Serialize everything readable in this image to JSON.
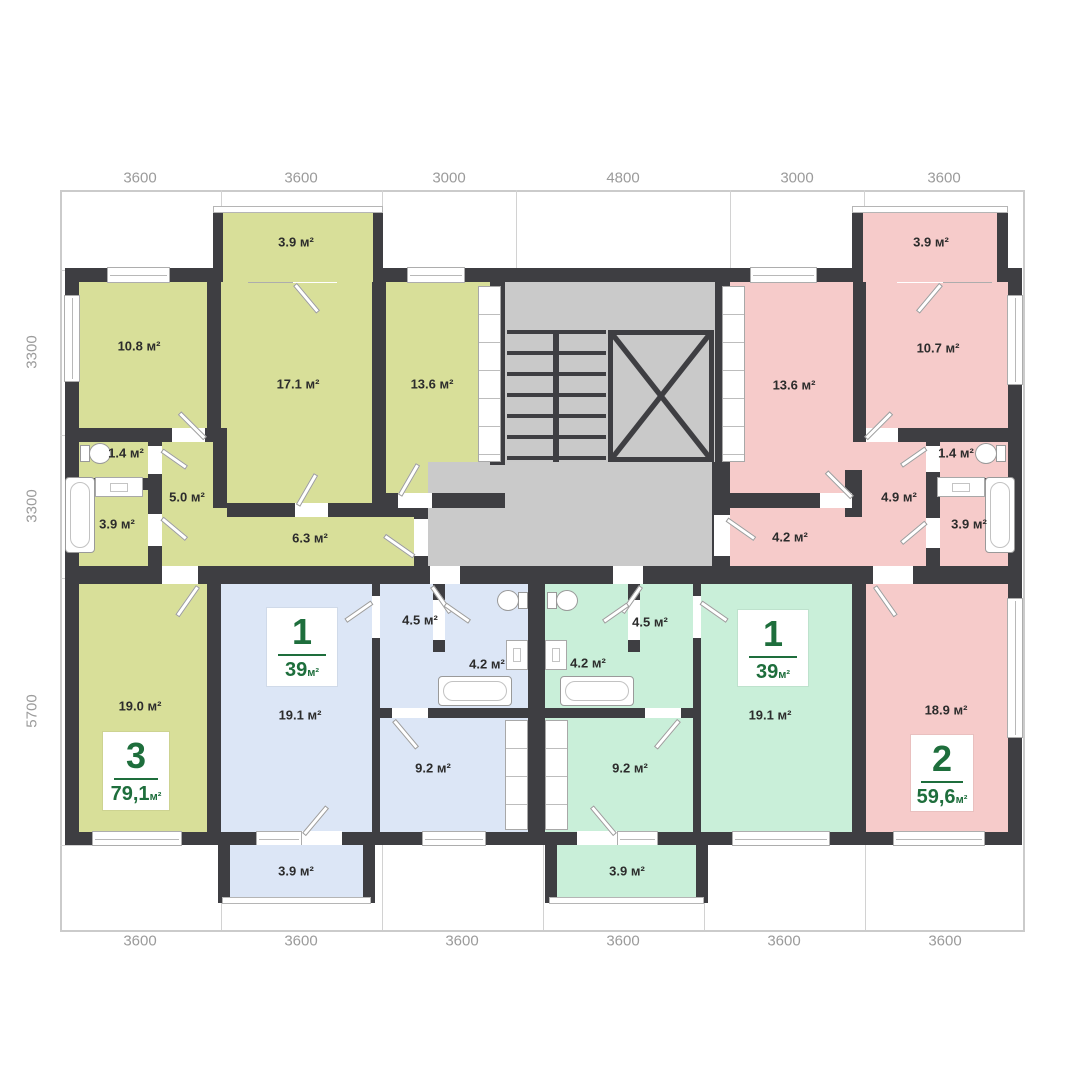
{
  "dimensions": {
    "top": [
      "3600",
      "3600",
      "3000",
      "4800",
      "3000",
      "3600"
    ],
    "bottom": [
      "3600",
      "3600",
      "3600",
      "3600",
      "3600",
      "3600"
    ],
    "left": [
      "3300",
      "3300",
      "5700"
    ]
  },
  "apartments": {
    "apt3": {
      "number": "3",
      "area": "79,1",
      "area_unit": "м²"
    },
    "apt1_blue": {
      "number": "1",
      "area": "39",
      "area_unit": "м²"
    },
    "apt1_mint": {
      "number": "1",
      "area": "39",
      "area_unit": "м²"
    },
    "apt2": {
      "number": "2",
      "area": "59,6",
      "area_unit": "м²"
    }
  },
  "rooms": {
    "o_108": "10.8 м²",
    "o_171": "17.1 м²",
    "o_136": "13.6 м²",
    "o_14": "1.4 м²",
    "o_50": "5.0 м²",
    "o_39": "3.9 м²",
    "o_63": "6.3 м²",
    "o_190": "19.0 м²",
    "o_balc": "3.9 м²",
    "b_191": "19.1 м²",
    "b_45": "4.5 м²",
    "b_42": "4.2 м²",
    "b_92": "9.2 м²",
    "b_balc": "3.9 м²",
    "m_45": "4.5 м²",
    "m_42": "4.2 м²",
    "m_92": "9.2 м²",
    "m_191": "19.1 м²",
    "m_balc": "3.9 м²",
    "p_136": "13.6 м²",
    "p_107": "10.7 м²",
    "p_14": "1.4 м²",
    "p_49": "4.9 м²",
    "p_39": "3.9 м²",
    "p_42": "4.2 м²",
    "p_189": "18.9 м²",
    "p_balc": "3.9 м²"
  },
  "colors": {
    "olive": "#d8df99",
    "pink": "#f6cbca",
    "blue": "#dce6f6",
    "mint": "#c9efd9",
    "core_gray": "#cacaca",
    "wall": "#3e3e42",
    "badge_green": "#1e6e3c",
    "dim_text": "#9b9b9b"
  }
}
